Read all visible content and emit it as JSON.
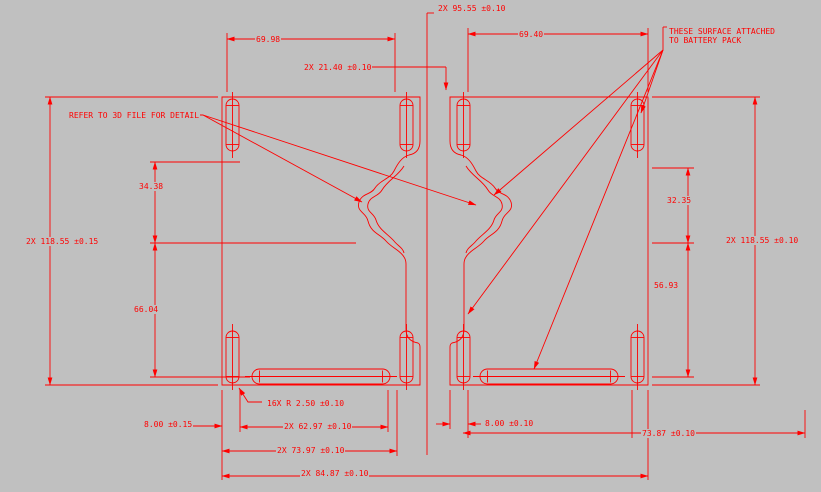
{
  "colors": {
    "background": "#c0c0c0",
    "line": "#ff0000",
    "text": "#ff0000"
  },
  "notes": {
    "refer": "REFER TO 3D FILE FOR DETAIL",
    "battery_line1": "THESE SURFACE ATTACHED",
    "battery_line2": "TO BATTERY PACK"
  },
  "dimensions": {
    "overall_pair_width": "2X 95.55 ±0.10",
    "left_part_top_width": "69.98",
    "right_part_top_width": "69.40",
    "tab_width": "2X 21.40 ±0.10",
    "left_upper_height": "34.38",
    "left_lower_height": "66.04",
    "left_overall_height": "2X 118.55 ±0.15",
    "right_upper_height": "32.35",
    "right_lower_height": "56.93",
    "right_overall_height": "2X 118.55 ±0.10",
    "corner_radius": "16X R 2.50 ±0.10",
    "left_tab_width": "8.00 ±0.15",
    "left_slot_width": "2X 62.97 ±0.10",
    "left_bottom_width": "2X 73.97 ±0.10",
    "overall_bottom_width": "2X 84.87 ±0.10",
    "right_tab_width": "8.00 ±0.10",
    "right_bottom_width": "73.87 ±0.10"
  }
}
